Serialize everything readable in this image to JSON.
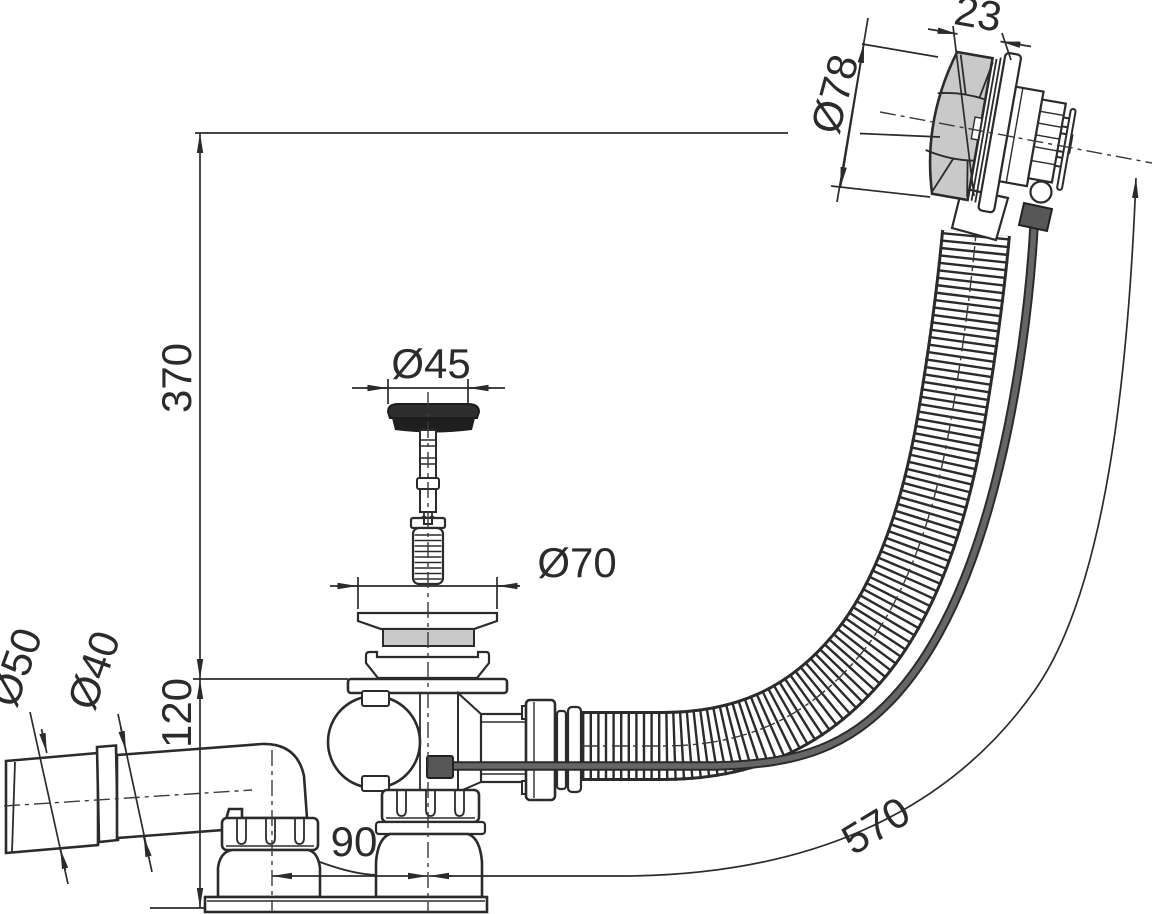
{
  "diagram": {
    "kind": "technical dimension drawing",
    "subject": "Bath waste and overflow set with plug, corrugated hose, bowden knob and side outlet elbow",
    "units": "mm",
    "line_color": "#2b2b2b",
    "accent_gray": "#c9c9c9",
    "cable_gray": "#666666",
    "labels": {
      "knob_width": "23",
      "knob_diameter": "Ø78",
      "plug_diameter": "Ø45",
      "flange_diameter": "Ø70",
      "height_overflow_to_flange": "370",
      "height_flange_to_base": "120",
      "outlet_large_diameter": "Ø50",
      "outlet_small_diameter": "Ø40",
      "outlet_offset": "90",
      "hose_length": "570"
    }
  }
}
